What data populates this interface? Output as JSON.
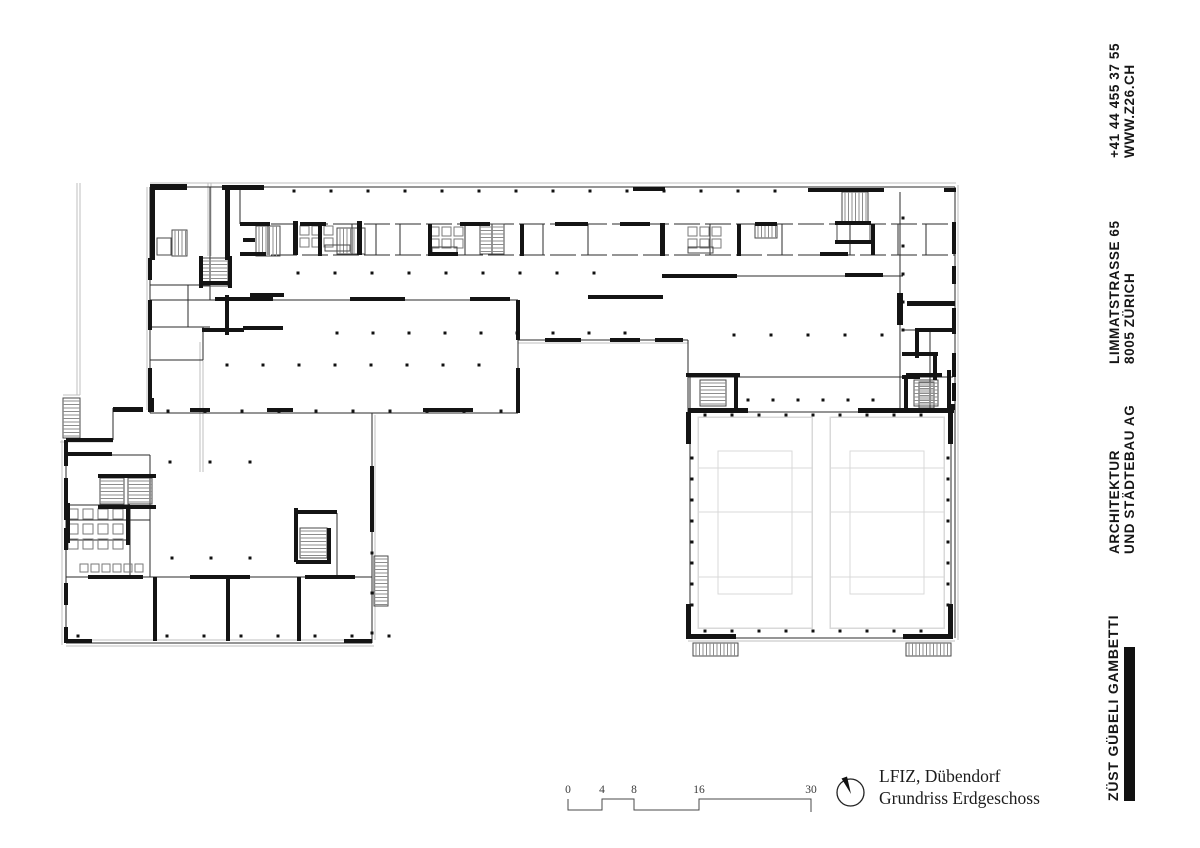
{
  "sidebar": {
    "phone": "+41 44 455 37 55",
    "web": "WWW.Z26.CH",
    "address_line1": "LIMMATSTRASSE 65",
    "address_line2": "8005 ZÜRICH",
    "firm_line1": "ARCHITEKTUR",
    "firm_line2": "UND STÄDTEBAU AG",
    "brand": "ZÜST GÜBELI GAMBETTI"
  },
  "titleblock": {
    "project": "LFIZ, Dübendorf",
    "drawing": "Grundriss Erdgeschoss"
  },
  "scalebar": {
    "labels": [
      "0",
      "4",
      "8",
      "16",
      "30"
    ],
    "label_x": [
      568,
      602,
      634,
      699,
      811
    ],
    "polyline": "568,799 568,810 602,810 602,799 634,799 634,810 699,810 699,799 811,799 811,812"
  },
  "colors": {
    "wall": "#141414",
    "thin": "#2b2b2b",
    "light": "#bfbfbf",
    "court": "#d9d9d9",
    "stair_edge": "#4a4a4a",
    "stair_hatch": "#8d8d8d",
    "dot": "#111111",
    "fixture": "#7a7a7a",
    "bar": "#111111"
  },
  "plan": {
    "thick": [
      [
        150,
        184,
        37,
        6
      ],
      [
        222,
        185,
        42,
        5
      ],
      [
        633,
        187,
        32,
        4
      ],
      [
        808,
        188,
        76,
        4
      ],
      [
        944,
        188,
        12,
        4
      ],
      [
        150,
        190,
        5,
        70
      ],
      [
        225,
        190,
        5,
        70
      ],
      [
        148,
        258,
        4,
        22
      ],
      [
        148,
        300,
        4,
        30
      ],
      [
        148,
        368,
        4,
        44
      ],
      [
        318,
        224,
        4,
        32
      ],
      [
        428,
        224,
        4,
        32
      ],
      [
        520,
        224,
        4,
        32
      ],
      [
        660,
        223,
        5,
        33
      ],
      [
        737,
        224,
        4,
        32
      ],
      [
        871,
        224,
        4,
        31
      ],
      [
        293,
        221,
        5,
        34
      ],
      [
        357,
        221,
        5,
        34
      ],
      [
        240,
        222,
        30,
        4
      ],
      [
        300,
        222,
        26,
        4
      ],
      [
        460,
        222,
        30,
        4
      ],
      [
        555,
        222,
        33,
        4
      ],
      [
        620,
        222,
        30,
        4
      ],
      [
        755,
        222,
        22,
        4
      ],
      [
        240,
        252,
        26,
        4
      ],
      [
        430,
        252,
        28,
        4
      ],
      [
        820,
        252,
        28,
        4
      ],
      [
        662,
        274,
        75,
        4
      ],
      [
        845,
        273,
        38,
        4
      ],
      [
        588,
        295,
        75,
        4
      ],
      [
        952,
        222,
        4,
        32
      ],
      [
        952,
        266,
        4,
        18
      ],
      [
        952,
        308,
        4,
        26
      ],
      [
        952,
        353,
        4,
        24
      ],
      [
        952,
        383,
        4,
        18
      ],
      [
        835,
        221,
        36,
        4
      ],
      [
        835,
        240,
        36,
        4
      ],
      [
        897,
        293,
        6,
        32
      ],
      [
        907,
        301,
        48,
        5
      ],
      [
        915,
        328,
        40,
        4
      ],
      [
        915,
        328,
        4,
        30
      ],
      [
        902,
        352,
        36,
        4
      ],
      [
        933,
        356,
        4,
        24
      ],
      [
        902,
        375,
        18,
        4
      ],
      [
        947,
        404,
        8,
        6
      ],
      [
        215,
        297,
        58,
        4
      ],
      [
        350,
        297,
        55,
        4
      ],
      [
        470,
        297,
        40,
        4
      ],
      [
        516,
        300,
        4,
        40
      ],
      [
        516,
        368,
        4,
        45
      ],
      [
        113,
        407,
        30,
        5
      ],
      [
        190,
        408,
        20,
        4
      ],
      [
        267,
        408,
        26,
        4
      ],
      [
        423,
        408,
        50,
        4
      ],
      [
        150,
        398,
        4,
        14
      ],
      [
        225,
        295,
        4,
        40
      ],
      [
        250,
        293,
        34,
        4
      ],
      [
        202,
        328,
        42,
        4
      ],
      [
        243,
        326,
        40,
        4
      ],
      [
        202,
        281,
        26,
        4
      ],
      [
        199,
        256,
        4,
        32
      ],
      [
        228,
        256,
        4,
        32
      ],
      [
        243,
        238,
        12,
        4
      ],
      [
        545,
        338,
        36,
        4
      ],
      [
        610,
        338,
        30,
        4
      ],
      [
        655,
        338,
        28,
        4
      ],
      [
        64,
        440,
        4,
        26
      ],
      [
        64,
        478,
        4,
        42
      ],
      [
        64,
        528,
        4,
        22
      ],
      [
        64,
        583,
        4,
        22
      ],
      [
        64,
        627,
        4,
        16
      ],
      [
        66,
        438,
        47,
        4
      ],
      [
        88,
        575,
        55,
        4
      ],
      [
        190,
        575,
        60,
        4
      ],
      [
        305,
        575,
        50,
        4
      ],
      [
        153,
        577,
        4,
        64
      ],
      [
        226,
        577,
        4,
        64
      ],
      [
        297,
        577,
        4,
        64
      ],
      [
        370,
        466,
        4,
        66
      ],
      [
        98,
        474,
        58,
        4
      ],
      [
        98,
        505,
        58,
        4
      ],
      [
        66,
        503,
        4,
        40
      ],
      [
        126,
        505,
        4,
        40
      ],
      [
        66,
        452,
        46,
        4
      ],
      [
        294,
        508,
        4,
        54
      ],
      [
        327,
        528,
        4,
        36
      ],
      [
        296,
        560,
        34,
        4
      ],
      [
        295,
        510,
        42,
        4
      ],
      [
        66,
        639,
        26,
        4
      ],
      [
        344,
        639,
        28,
        4
      ],
      [
        688,
        408,
        60,
        5
      ],
      [
        858,
        408,
        96,
        5
      ],
      [
        686,
        412,
        5,
        32
      ],
      [
        686,
        604,
        5,
        35
      ],
      [
        948,
        412,
        5,
        32
      ],
      [
        948,
        604,
        5,
        35
      ],
      [
        688,
        634,
        48,
        5
      ],
      [
        903,
        634,
        50,
        5
      ],
      [
        686,
        373,
        54,
        4
      ],
      [
        906,
        373,
        36,
        4
      ],
      [
        947,
        370,
        4,
        40
      ],
      [
        734,
        377,
        4,
        34
      ],
      [
        904,
        377,
        4,
        34
      ]
    ],
    "thin": [
      [
        150,
        187,
        955,
        187
      ],
      [
        955,
        187,
        955,
        638
      ],
      [
        240,
        187,
        240,
        224
      ],
      [
        210,
        187,
        210,
        300
      ],
      [
        150,
        285,
        210,
        285
      ],
      [
        150,
        327,
        210,
        327
      ],
      [
        188,
        285,
        188,
        327
      ],
      [
        150,
        360,
        203,
        360
      ],
      [
        203,
        327,
        203,
        360
      ],
      [
        150,
        300,
        518,
        300
      ],
      [
        518,
        300,
        518,
        413
      ],
      [
        150,
        413,
        518,
        413
      ],
      [
        150,
        187,
        150,
        413
      ],
      [
        518,
        340,
        688,
        340
      ],
      [
        588,
        297,
        662,
        297
      ],
      [
        662,
        276,
        903,
        276
      ],
      [
        688,
        340,
        688,
        412
      ],
      [
        900,
        192,
        900,
        410
      ],
      [
        903,
        330,
        955,
        330
      ],
      [
        930,
        330,
        930,
        410
      ],
      [
        66,
        440,
        66,
        643
      ],
      [
        66,
        643,
        372,
        643
      ],
      [
        372,
        413,
        372,
        643
      ],
      [
        66,
        577,
        372,
        577
      ],
      [
        66,
        520,
        150,
        520
      ],
      [
        150,
        455,
        150,
        577
      ],
      [
        66,
        455,
        150,
        455
      ],
      [
        66,
        505,
        130,
        505
      ],
      [
        130,
        505,
        130,
        577
      ],
      [
        66,
        540,
        130,
        540
      ],
      [
        113,
        408,
        113,
        440
      ],
      [
        337,
        513,
        337,
        577
      ],
      [
        688,
        377,
        953,
        377
      ],
      [
        688,
        412,
        953,
        412
      ],
      [
        688,
        638,
        953,
        638
      ],
      [
        690,
        377,
        690,
        638
      ],
      [
        951,
        412,
        951,
        638
      ]
    ],
    "dashed": [
      [
        240,
        224,
        955,
        224
      ],
      [
        240,
        255,
        955,
        255
      ]
    ],
    "part_xs": [
      268,
      296,
      352,
      376,
      400,
      465,
      492,
      543,
      588,
      710,
      782,
      850,
      898,
      926
    ],
    "part_y": [
      224,
      255
    ],
    "light": [
      [
        150,
        183,
        956,
        183
      ],
      [
        958,
        185,
        958,
        640
      ],
      [
        688,
        641,
        955,
        641
      ],
      [
        66,
        646,
        374,
        646
      ],
      [
        62,
        440,
        62,
        645
      ],
      [
        375,
        415,
        375,
        640
      ],
      [
        147,
        187,
        147,
        410
      ],
      [
        77,
        183,
        77,
        395
      ],
      [
        80,
        183,
        80,
        395
      ],
      [
        208,
        183,
        208,
        256
      ],
      [
        211,
        183,
        211,
        256
      ],
      [
        63,
        395,
        80,
        395
      ],
      [
        200,
        342,
        200,
        472
      ],
      [
        203,
        342,
        203,
        472
      ],
      [
        518,
        343,
        688,
        343
      ],
      [
        66,
        640,
        372,
        640
      ],
      [
        60,
        442,
        113,
        442
      ]
    ],
    "stairs": [
      {
        "x": 172,
        "y": 230,
        "w": 15,
        "h": 26,
        "dir": "v"
      },
      {
        "x": 202,
        "y": 258,
        "w": 26,
        "h": 28,
        "dir": "h"
      },
      {
        "x": 256,
        "y": 226,
        "w": 24,
        "h": 30,
        "dir": "v"
      },
      {
        "x": 337,
        "y": 228,
        "w": 28,
        "h": 26,
        "dir": "v"
      },
      {
        "x": 480,
        "y": 224,
        "w": 24,
        "h": 30,
        "dir": "h"
      },
      {
        "x": 755,
        "y": 224,
        "w": 22,
        "h": 14,
        "dir": "v"
      },
      {
        "x": 842,
        "y": 192,
        "w": 26,
        "h": 30,
        "dir": "v"
      },
      {
        "x": 919,
        "y": 382,
        "w": 15,
        "h": 26,
        "dir": "h"
      },
      {
        "x": 700,
        "y": 380,
        "w": 26,
        "h": 26,
        "dir": "h"
      },
      {
        "x": 914,
        "y": 380,
        "w": 24,
        "h": 26,
        "dir": "h"
      },
      {
        "x": 693,
        "y": 643,
        "w": 45,
        "h": 13,
        "dir": "v"
      },
      {
        "x": 906,
        "y": 643,
        "w": 45,
        "h": 13,
        "dir": "v"
      },
      {
        "x": 100,
        "y": 478,
        "w": 24,
        "h": 26,
        "dir": "h"
      },
      {
        "x": 128,
        "y": 478,
        "w": 24,
        "h": 26,
        "dir": "h"
      },
      {
        "x": 300,
        "y": 528,
        "w": 27,
        "h": 30,
        "dir": "h"
      },
      {
        "x": 374,
        "y": 556,
        "w": 14,
        "h": 50,
        "dir": "h"
      },
      {
        "x": 63,
        "y": 398,
        "w": 17,
        "h": 40,
        "dir": "h"
      }
    ],
    "dot_rows": [
      {
        "y": 191,
        "x0": 294,
        "x1": 806,
        "step": 37
      },
      {
        "y": 273,
        "x0": 298,
        "x1": 628,
        "step": 37
      },
      {
        "y": 333,
        "x0": 337,
        "x1": 628,
        "step": 36
      },
      {
        "y": 365,
        "x0": 227,
        "x1": 500,
        "step": 36
      },
      {
        "y": 411,
        "x0": 168,
        "x1": 515,
        "step": 37
      },
      {
        "y": 462,
        "x0": 170,
        "x1": 250,
        "step": 40
      },
      {
        "y": 558,
        "x0": 172,
        "x1": 250,
        "step": 39
      },
      {
        "y": 636,
        "x0": 167,
        "x1": 407,
        "step": 37
      },
      {
        "y": 636,
        "x0": 78,
        "x1": 78,
        "step": 37
      },
      {
        "y": 415,
        "x0": 705,
        "x1": 945,
        "step": 27
      },
      {
        "y": 631,
        "x0": 705,
        "x1": 945,
        "step": 27
      },
      {
        "y": 335,
        "x0": 734,
        "x1": 882,
        "step": 37
      },
      {
        "y": 400,
        "x0": 748,
        "x1": 896,
        "step": 25
      }
    ],
    "dot_cols": [
      {
        "x": 692,
        "y0": 458,
        "y1": 608,
        "step": 21
      },
      {
        "x": 948,
        "y0": 458,
        "y1": 608,
        "step": 21
      },
      {
        "x": 372,
        "y0": 553,
        "y1": 633,
        "step": 40
      },
      {
        "x": 903,
        "y0": 218,
        "y1": 330,
        "step": 28
      }
    ],
    "courts": [
      {
        "x": 698,
        "y": 417,
        "w": 114,
        "h": 211
      },
      {
        "x": 830,
        "y": 417,
        "w": 114,
        "h": 211
      }
    ],
    "court_hlines": [
      468,
      512,
      577
    ],
    "court_inset": {
      "ix": 20,
      "iy": 34
    },
    "fixtures": [
      {
        "x": 68,
        "y": 509,
        "cols": 4,
        "rows": 3,
        "cell": 10,
        "gap": 5
      },
      {
        "x": 80,
        "y": 564,
        "cols": 6,
        "rows": 1,
        "cell": 8,
        "gap": 3
      },
      {
        "x": 300,
        "y": 226,
        "cols": 3,
        "rows": 2,
        "cell": 9,
        "gap": 3
      },
      {
        "x": 430,
        "y": 227,
        "cols": 3,
        "rows": 2,
        "cell": 9,
        "gap": 3
      },
      {
        "x": 688,
        "y": 227,
        "cols": 3,
        "rows": 2,
        "cell": 9,
        "gap": 3
      }
    ],
    "boxes": [
      [
        837,
        224,
        33,
        18
      ],
      [
        157,
        238,
        14,
        17
      ],
      [
        688,
        247,
        25,
        6
      ],
      [
        325,
        245,
        25,
        6
      ],
      [
        432,
        247,
        25,
        6
      ]
    ]
  }
}
